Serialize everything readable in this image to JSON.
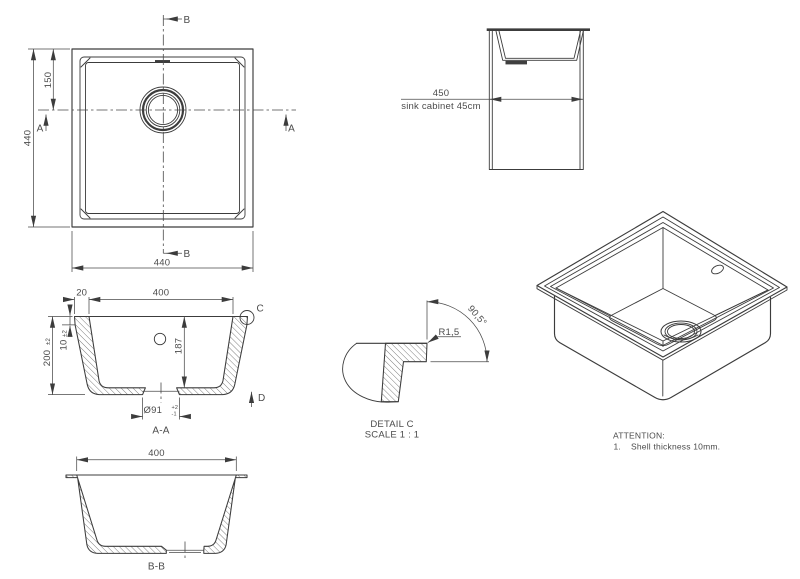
{
  "colors": {
    "line": "#3c3c3c",
    "text": "#4b4b4b",
    "background": "#ffffff"
  },
  "top_view": {
    "section_b_top": "B",
    "section_b_bottom": "B",
    "section_a_left": "A",
    "section_a_right": "A",
    "dim_height": "440",
    "dim_drain_offset": "150",
    "dim_width": "440"
  },
  "cabinet_view": {
    "dim_width": "450",
    "caption": "sink cabinet 45cm"
  },
  "section_aa": {
    "dim_rim_thickness": "20",
    "dim_inner_width": "400",
    "dim_height": "200",
    "dim_height_tol": "±2",
    "dim_flange": "10",
    "dim_flange_tol": "±2",
    "dim_depth": "187",
    "dim_drain_dia": "Ø91",
    "dim_drain_tol_plus": "+2",
    "dim_drain_tol_minus": "-1",
    "detail_marker": "C",
    "view_marker": "D",
    "label": "A-A"
  },
  "detail_c": {
    "radius_label": "R1,5",
    "angle_label": "90,5°",
    "title": "DETAIL C",
    "scale_label": "SCALE 1 : 1"
  },
  "section_bb": {
    "dim_inner_width": "400",
    "label": "B-B"
  },
  "attention": {
    "title": "ATTENTION:",
    "note_number": "1.",
    "note_text": "Shell thickness 10mm."
  }
}
